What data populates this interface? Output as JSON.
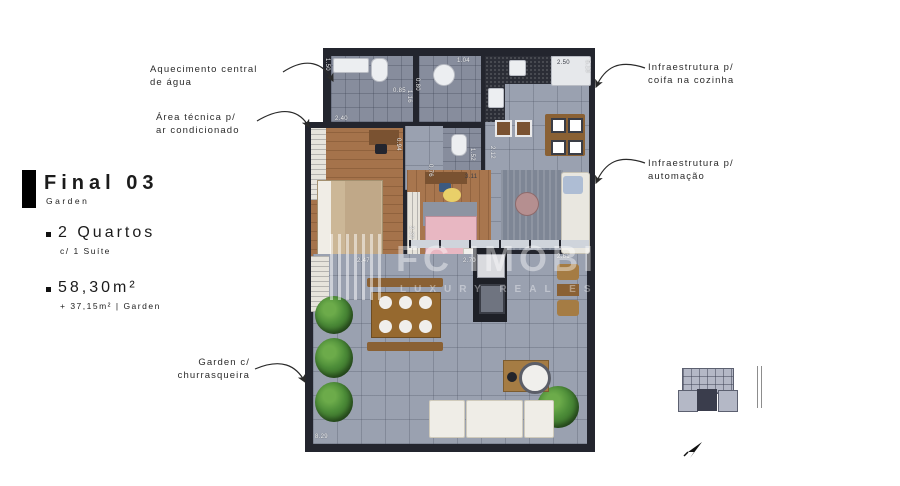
{
  "info_panel": {
    "title": "Final 03",
    "subtitle": "Garden",
    "features": [
      {
        "label": "2 Quartos",
        "sublabel": "c/ 1 Suíte"
      },
      {
        "label": "58,30m²",
        "sublabel": "+ 37,15m² | Garden"
      }
    ]
  },
  "annotations": [
    {
      "id": "aquecimento",
      "lines": [
        "Aquecimento central",
        "de água"
      ]
    },
    {
      "id": "area-tecnica",
      "lines": [
        "Área técnica p/",
        "ar condicionado"
      ]
    },
    {
      "id": "coifa",
      "lines": [
        "Infraestrutura p/",
        "coifa na cozinha"
      ]
    },
    {
      "id": "automacao",
      "lines": [
        "Infraestrutura p/",
        "automação"
      ]
    },
    {
      "id": "garden",
      "lines": [
        "Garden c/",
        "churrasqueira"
      ]
    }
  ],
  "watermark": {
    "brand": "FC IMOBILE",
    "tagline": "LUXURY REAL ESTATE"
  },
  "plan": {
    "measurements": [
      {
        "value": "1.50"
      },
      {
        "value": "0.85"
      },
      {
        "value": "2.40"
      },
      {
        "value": "1.16"
      },
      {
        "value": "1.04"
      },
      {
        "value": "0.80"
      },
      {
        "value": "0.76"
      },
      {
        "value": "1.52"
      },
      {
        "value": "2.50"
      },
      {
        "value": "5.10"
      },
      {
        "value": "2.12"
      },
      {
        "value": "3.11"
      },
      {
        "value": "0.94"
      },
      {
        "value": "2.47"
      },
      {
        "value": "2.39"
      },
      {
        "value": "2.70"
      },
      {
        "value": "2.61"
      },
      {
        "value": "8.29"
      }
    ]
  },
  "colors": {
    "accent": "#000000",
    "wall": "#23252e",
    "tile": "#9aa1b0",
    "wood": "#a5734b",
    "garden_green": "#4c8c38",
    "bed_suite": "#ccb797",
    "bed_pink": "#e8b7c2"
  }
}
